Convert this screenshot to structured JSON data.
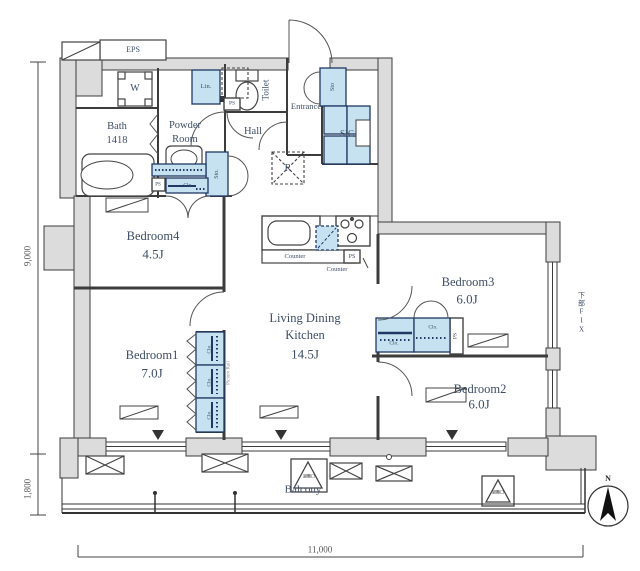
{
  "rooms": {
    "ldk": {
      "line1": "Living Dining",
      "line2": "Kitchen",
      "size": "14.5J"
    },
    "bedroom1": {
      "name": "Bedroom1",
      "size": "7.0J"
    },
    "bedroom2": {
      "name": "Bedroom2",
      "size": "6.0J"
    },
    "bedroom3": {
      "name": "Bedroom3",
      "size": "6.0J"
    },
    "bedroom4": {
      "name": "Bedroom4",
      "size": "4.5J"
    },
    "bath": {
      "name": "Bath",
      "size": "1418"
    },
    "powder": {
      "line1": "Powder",
      "line2": "Room"
    },
    "toilet": {
      "name": "Toilet"
    },
    "hall": {
      "name": "Hall"
    },
    "entrance": {
      "name": "Entrance"
    },
    "balcony": {
      "name": "Balcony"
    },
    "sic": {
      "name": "SIC"
    }
  },
  "fixtures": {
    "eps": "EPS",
    "washer": "W",
    "linen": "Lin.",
    "storage_top": "Sto",
    "storage_mid": "Sto.",
    "closet": "Clo.",
    "pipe_space": "PS",
    "refrigerator": "R",
    "counter": "Counter",
    "fix_window": "下部FIX",
    "picture_rail": "Picture Rail",
    "evac_hatch": "避難口"
  },
  "dimensions": {
    "left_height": "9,000",
    "balcony_depth": "1,800",
    "bottom_width": "11,000"
  },
  "compass": {
    "north": "N"
  },
  "colors": {
    "wall": "#dcdcdc",
    "fixture_blue": "#c6e2f0",
    "fixture_border": "#1f3864",
    "label_text": "#3f4e66",
    "line": "#3c3c3c"
  }
}
